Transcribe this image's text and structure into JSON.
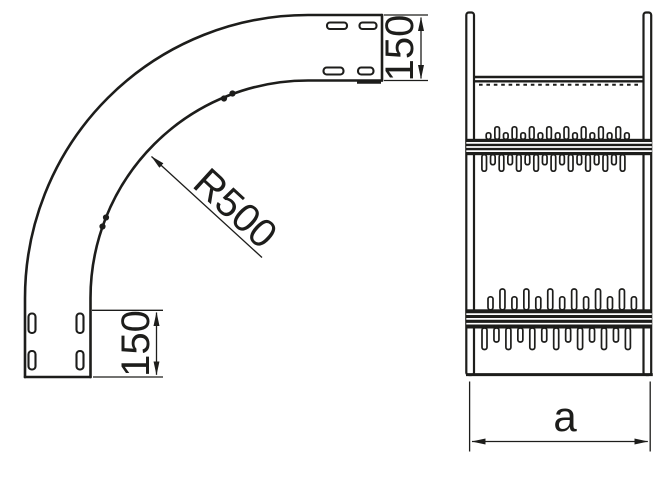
{
  "figure": {
    "kind": "technical-drawing",
    "subject": "90-degree-vertical-bend-cable-tray",
    "line_color": "#1d1d1b",
    "background_color": "#ffffff"
  },
  "labels": {
    "radius": "R500",
    "top_end_dim": "150",
    "bottom_end_dim": "150",
    "width_dim": "a"
  },
  "bands": [
    {
      "name": "expansion-joint-upper",
      "stripe": {
        "x": 466.3,
        "y": 138.8,
        "w": 185.5,
        "h": 16.4,
        "white_lines": 3
      },
      "top_tabs": {
        "n": 17,
        "x0": 488.5,
        "dx": 8.65,
        "w": 4.6,
        "h_short": 6.5,
        "h_tall": 12.5,
        "tall_first": false
      },
      "bottom_tabs": {
        "n": 17,
        "x0": 484.2,
        "dx": 8.65,
        "w": 4.6,
        "h_short": 10,
        "h_tall": 16.5,
        "tall_first": true
      }
    },
    {
      "name": "expansion-joint-lower",
      "stripe": {
        "x": 466.3,
        "y": 309.3,
        "w": 185.5,
        "h": 19.2,
        "white_lines": 3
      },
      "top_tabs": {
        "n": 13,
        "x0": 490.5,
        "dx": 11.95,
        "w": 5,
        "h_short": 13,
        "h_tall": 20.8,
        "tall_first": false
      },
      "bottom_tabs": {
        "n": 13,
        "x0": 484.5,
        "dx": 11.95,
        "w": 5,
        "h_short": 14,
        "h_tall": 21.5,
        "tall_first": true
      }
    }
  ]
}
